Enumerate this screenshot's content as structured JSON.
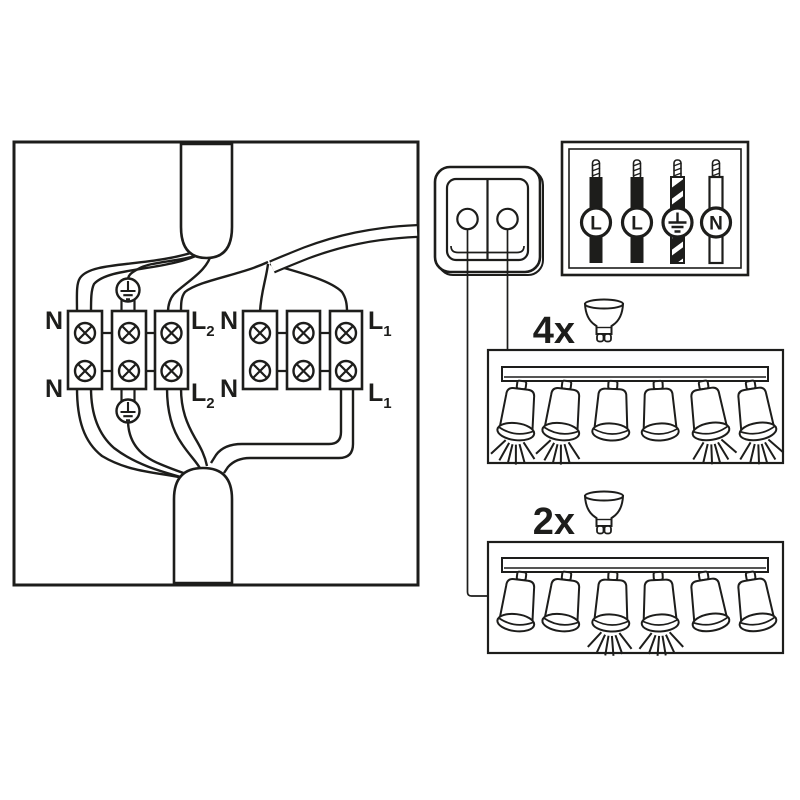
{
  "colors": {
    "line": "#1d1d1b",
    "background": "#ffffff"
  },
  "junction_box": {
    "labels": {
      "neutral": "N",
      "live": "L",
      "sub_circuit_1": "1",
      "sub_circuit_2": "2"
    },
    "terminal_groups": 2,
    "terminal_blocks_per_group": 3,
    "screws_per_block": 2,
    "earth_connectors": 2,
    "cables": [
      "top-supply-cable",
      "right-switch-cable",
      "bottom-fixture-cable"
    ]
  },
  "switch": {
    "type": "double-rocker-wall-switch",
    "buttons": 2
  },
  "wire_legend": {
    "wires": [
      {
        "label": "L",
        "insulation": "black"
      },
      {
        "label": "L",
        "insulation": "black"
      },
      {
        "symbol": "earth",
        "insulation": "striped"
      },
      {
        "label": "N",
        "insulation": "white"
      }
    ]
  },
  "fixtures": [
    {
      "count_label": "4x",
      "bulb_icon": "gu10-bulb",
      "spots_total": 6,
      "lit_spots": [
        1,
        2,
        5,
        6
      ]
    },
    {
      "count_label": "2x",
      "bulb_icon": "gu10-bulb",
      "spots_total": 6,
      "lit_spots": [
        3,
        4
      ]
    }
  ]
}
